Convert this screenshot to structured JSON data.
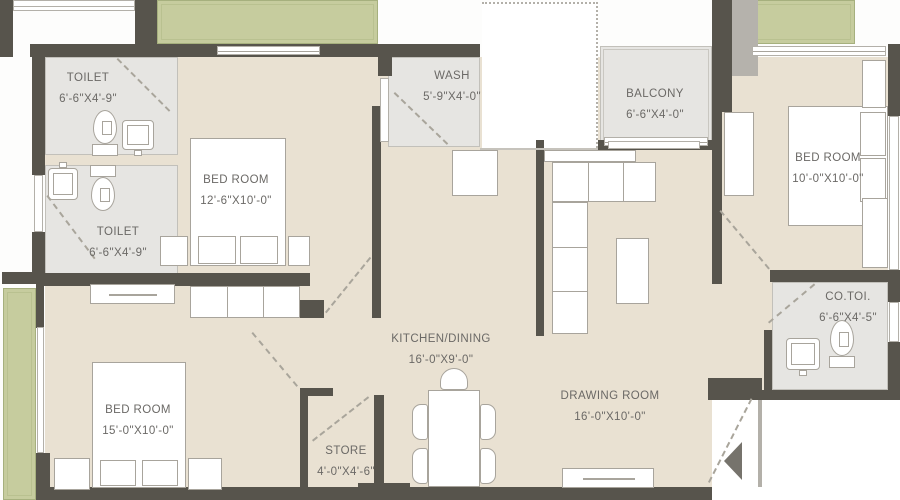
{
  "plan": {
    "title": "apartment-floor-plan",
    "colors": {
      "wall": "#57544c",
      "floor": "#e9e1d2",
      "wet_room": "#e6e5e2",
      "planter_green": "#c6cc9e",
      "label_text": "#6b6966",
      "furniture_outline": "#a8a49c",
      "outside": "#ffffff"
    },
    "entry": {
      "arrow_direction": "left"
    },
    "rooms": [
      {
        "id": "toilet-1",
        "name": "TOILET",
        "dims": "6'-6\"X4'-9\""
      },
      {
        "id": "bedroom-1",
        "name": "BED ROOM",
        "dims": "12'-6\"X10'-0\""
      },
      {
        "id": "toilet-2",
        "name": "TOILET",
        "dims": "6'-6\"X4'-9\""
      },
      {
        "id": "wash",
        "name": "WASH",
        "dims": "5'-9\"X4'-0\""
      },
      {
        "id": "balcony",
        "name": "BALCONY",
        "dims": "6'-6\"X4'-0\""
      },
      {
        "id": "bedroom-2",
        "name": "BED ROOM",
        "dims": "10'-0\"X10'-0\""
      },
      {
        "id": "co-toilet",
        "name": "CO.TOI.",
        "dims": "6'-6\"X4'-5\""
      },
      {
        "id": "kitchen-dining",
        "name": "KITCHEN/DINING",
        "dims": "16'-0\"X9'-0\""
      },
      {
        "id": "drawing-room",
        "name": "DRAWING ROOM",
        "dims": "16'-0\"X10'-0\""
      },
      {
        "id": "bedroom-3",
        "name": "BED ROOM",
        "dims": "15'-0\"X10'-0\""
      },
      {
        "id": "store",
        "name": "STORE",
        "dims": "4'-0\"X4'-6\""
      }
    ]
  }
}
